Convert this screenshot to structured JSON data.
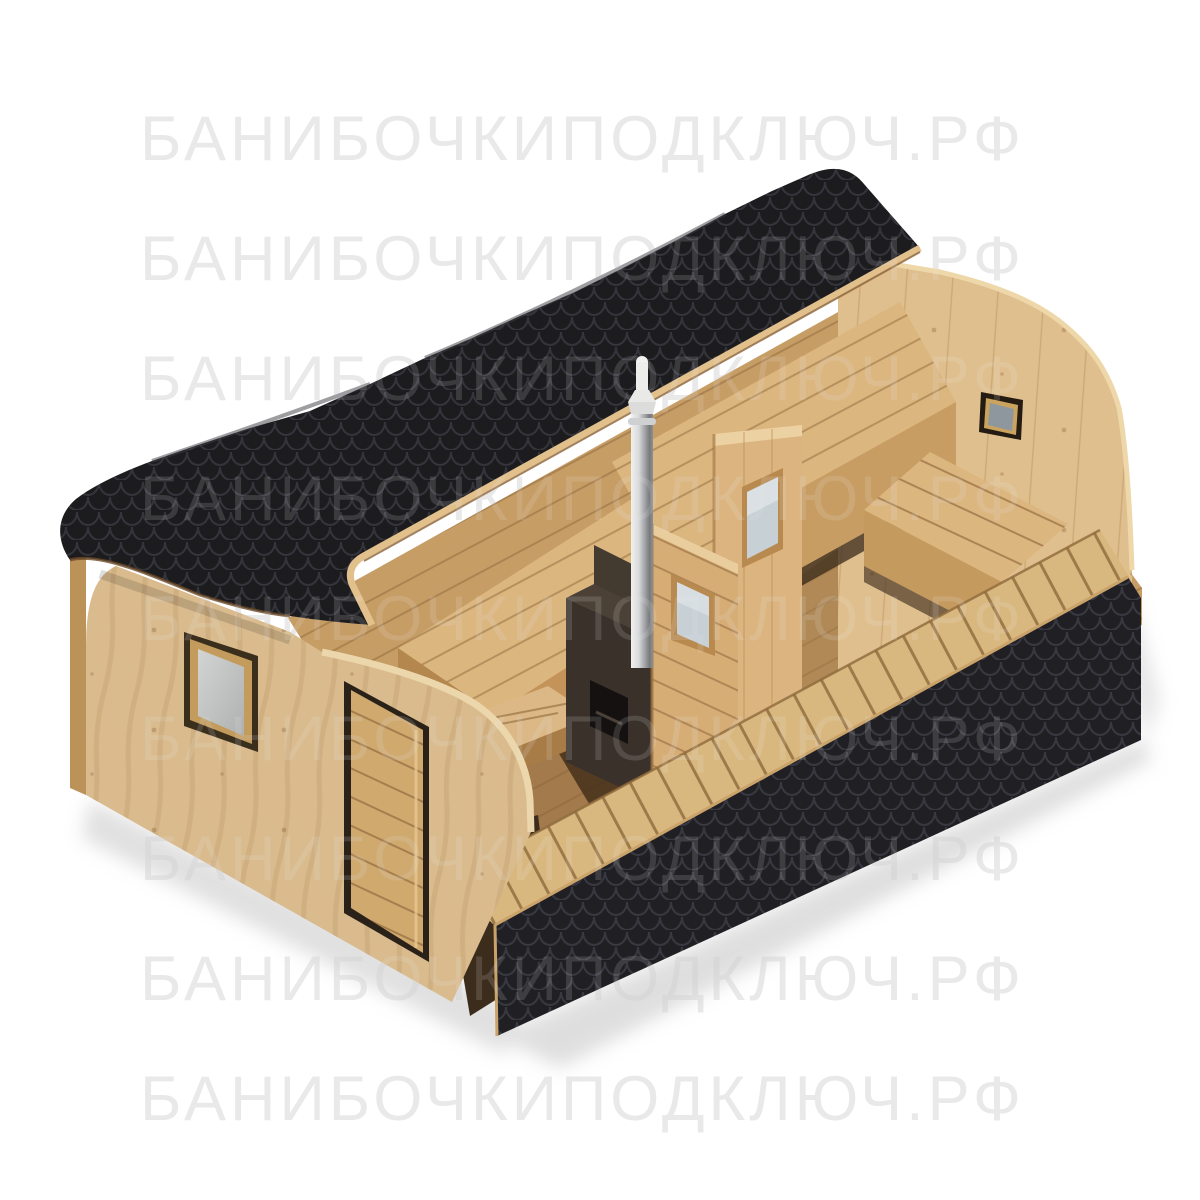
{
  "image": {
    "kind": "3d-product-render",
    "subject": "cutaway render of a rectangular barrel sauna (quadro-bochka) with black shingle roof, interior stove with chimney, benches, partition doors and entrance door"
  },
  "watermark": {
    "text": "БАНИБОЧКИПОДКЛЮЧ.РФ",
    "rows": 9,
    "color": "#e9e9e9",
    "overlay_opacity": "0.15"
  },
  "colors": {
    "background": "#ffffff",
    "roof_black": "#1c1c1f",
    "roof_scale_line": "#34343b",
    "skirt_black": "#202024",
    "skirt_scale_line": "#383840",
    "wood_wall": "#d9bb8e",
    "wood_rear_wall": "#e0bf8e",
    "wood_floor": "#c79d66",
    "wood_bench_top": "#dcb67f",
    "wood_bench_face": "#c89d63",
    "wood_deck": "#d9b87f",
    "wood_rim": "#e2c08c",
    "wood_panel": "#dcb480",
    "wood_panel_b": "#d7ad76",
    "wood_door": "#cfa96e",
    "door_frame_dark": "#2a2119",
    "stove_body": "#3a312a",
    "stove_upper": "#433a30",
    "stove_door": "#141110",
    "chimney_light": "#f1f1ef",
    "chimney_dark": "#77797c",
    "glass_front_window": "#c6c9c7",
    "glass_rear_window": "#8e979e",
    "glass_partition": "#c6d0d5",
    "ground_shadow": "#c9c9c9"
  },
  "parts": {
    "roof": "black fish-scale shingle barrel roof (front half, cut along ridge)",
    "roof_rim": "plywood edge of the roof cut",
    "front_wall": "left end wall with window and entrance door",
    "front_window": "square window with gray glazing",
    "entrance_door": "wooden door with horizontal slats",
    "rear_wall": "arched rear wall with two small windows",
    "floor": "interior plank floor",
    "benches": "interior benches along walls",
    "steam_bench": "steam-room bench platform",
    "stool": "small slatted stool",
    "partition_a": "partition door panel with glazed window (rear)",
    "partition_b": "partition door panel with glazed window (front)",
    "stove": "dark sauna stove",
    "chimney": "stainless steel chimney with cap",
    "deck_edge": "cut plank deck edge with joists",
    "skirt": "black fish-scale shingle lower band (cut face)"
  }
}
